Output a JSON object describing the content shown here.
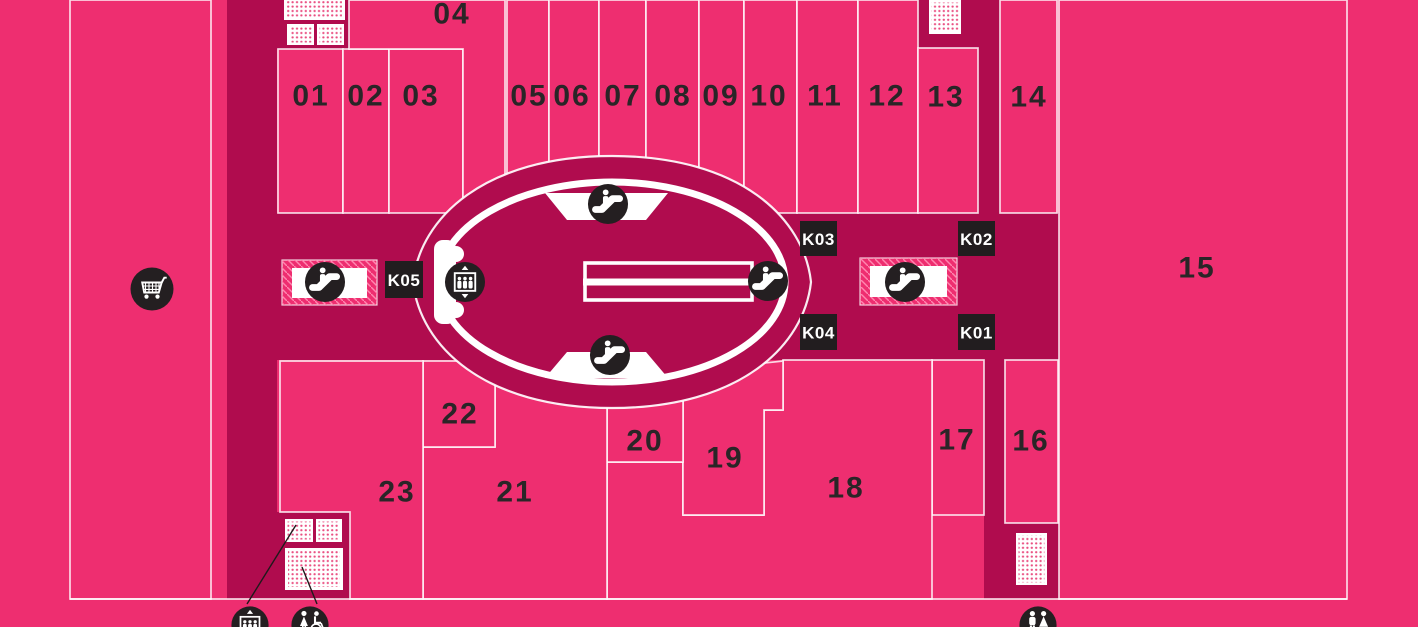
{
  "map": {
    "name": "Shopping mall floor plan",
    "colors": {
      "background_pink": "#EE2E70",
      "corridor_crimson": "#B00C4E",
      "icon_black": "#241F21",
      "kiosk_badge_black": "#221D1F",
      "label_ink": "#2A2527",
      "outline_white": "#FFFFFF"
    },
    "units": [
      {
        "label": "01"
      },
      {
        "label": "02"
      },
      {
        "label": "03"
      },
      {
        "label": "04"
      },
      {
        "label": "05"
      },
      {
        "label": "06"
      },
      {
        "label": "07"
      },
      {
        "label": "08"
      },
      {
        "label": "09"
      },
      {
        "label": "10"
      },
      {
        "label": "11"
      },
      {
        "label": "12"
      },
      {
        "label": "13"
      },
      {
        "label": "14"
      },
      {
        "label": "15"
      },
      {
        "label": "16"
      },
      {
        "label": "17"
      },
      {
        "label": "18"
      },
      {
        "label": "19"
      },
      {
        "label": "20"
      },
      {
        "label": "21"
      },
      {
        "label": "22"
      },
      {
        "label": "23"
      }
    ],
    "kiosks": [
      {
        "label": "K01"
      },
      {
        "label": "K02"
      },
      {
        "label": "K03"
      },
      {
        "label": "K04"
      },
      {
        "label": "K05"
      }
    ],
    "icons": [
      {
        "name": "shopping-cart-icon"
      },
      {
        "name": "elevator-icon"
      },
      {
        "name": "escalator-icon"
      },
      {
        "name": "accessible-toilet-icon"
      },
      {
        "name": "toilet-icon"
      }
    ]
  }
}
